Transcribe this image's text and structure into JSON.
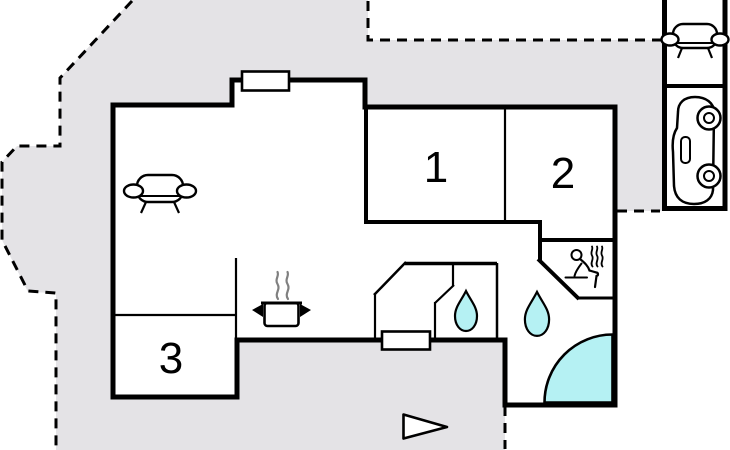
{
  "plan": {
    "type": "holiday-home-floor-plan",
    "rooms": {
      "bedroom_1": "1",
      "bedroom_2": "2",
      "room_3": "3"
    },
    "colors": {
      "terrace": "#e4e3e6",
      "water": "#b5f1f3",
      "walls": "#000000",
      "paper": "#ffffff",
      "steam": "#808080"
    },
    "icons": {
      "living_room": "sofa-icon",
      "annex_lounge": "sofa-icon",
      "garage": "car-icon",
      "kitchen": "cooking-pot-icon",
      "shower_room": "water-drop-icon",
      "bathroom": "water-drop-icon",
      "sauna": "sauna-person-icon",
      "corner_bath": "corner-bathtub",
      "terrace_marker": "triangle-pointer-icon"
    }
  }
}
